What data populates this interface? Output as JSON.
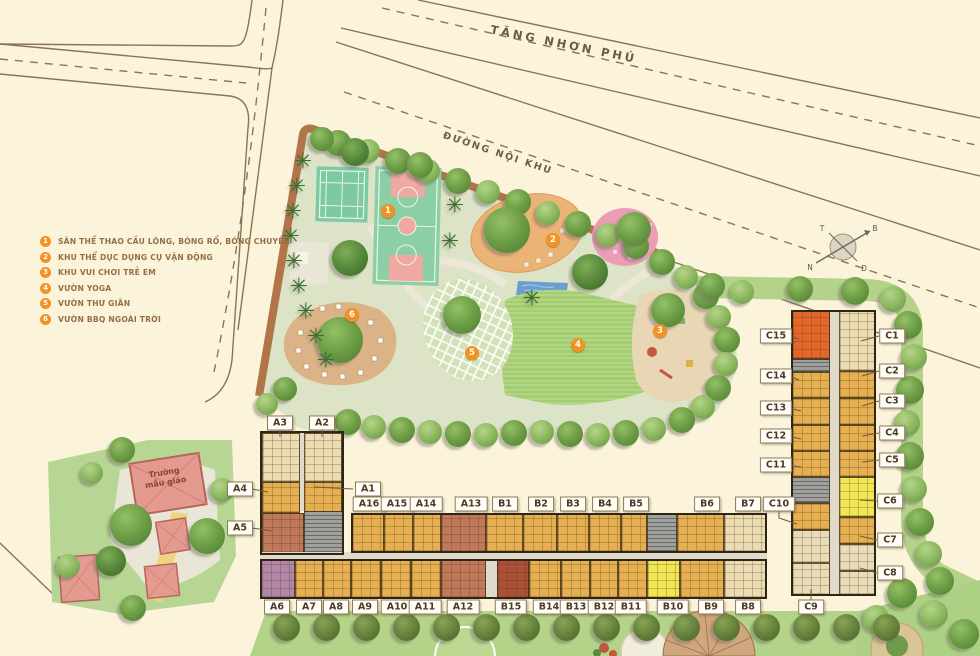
{
  "roads": {
    "main_label": "TĂNG NHƠN PHÚ",
    "internal_label": "ĐƯỜNG NỘI KHU"
  },
  "legend": {
    "items": [
      {
        "num": "1",
        "label": "SÂN THỂ THAO CẦU LÔNG, BÓNG RỔ, BÓNG CHUYỀN"
      },
      {
        "num": "2",
        "label": "KHU THỂ DỤC DỤNG CỤ VẬN ĐỘNG"
      },
      {
        "num": "3",
        "label": "KHU VUI CHƠI TRẺ EM"
      },
      {
        "num": "4",
        "label": "VƯỜN YOGA"
      },
      {
        "num": "5",
        "label": "VƯỜN THƯ GIÃN"
      },
      {
        "num": "6",
        "label": "VƯỜN BBQ NGOÀI TRỜI"
      }
    ]
  },
  "kindergarten": {
    "label": "Trường mẫu giáo"
  },
  "compass": {
    "north": "B",
    "south": "N",
    "east": "Đ",
    "west": "T"
  },
  "markers": [
    {
      "num": "1",
      "x": 388,
      "y": 211
    },
    {
      "num": "2",
      "x": 553,
      "y": 240
    },
    {
      "num": "3",
      "x": 660,
      "y": 331
    },
    {
      "num": "4",
      "x": 578,
      "y": 345
    },
    {
      "num": "5",
      "x": 472,
      "y": 353
    },
    {
      "num": "6",
      "x": 352,
      "y": 315
    }
  ],
  "building_labels": [
    {
      "id": "A3",
      "x": 280,
      "y": 423
    },
    {
      "id": "A2",
      "x": 322,
      "y": 423
    },
    {
      "id": "A4",
      "x": 240,
      "y": 489
    },
    {
      "id": "A5",
      "x": 240,
      "y": 528
    },
    {
      "id": "A1",
      "x": 368,
      "y": 489
    },
    {
      "id": "A16",
      "x": 369,
      "y": 504
    },
    {
      "id": "A15",
      "x": 397,
      "y": 504
    },
    {
      "id": "A14",
      "x": 426,
      "y": 504
    },
    {
      "id": "A13",
      "x": 471,
      "y": 504
    },
    {
      "id": "B1",
      "x": 505,
      "y": 504
    },
    {
      "id": "B2",
      "x": 541,
      "y": 504
    },
    {
      "id": "B3",
      "x": 573,
      "y": 504
    },
    {
      "id": "B4",
      "x": 605,
      "y": 504
    },
    {
      "id": "B5",
      "x": 636,
      "y": 504
    },
    {
      "id": "B6",
      "x": 707,
      "y": 504
    },
    {
      "id": "B7",
      "x": 748,
      "y": 504
    },
    {
      "id": "C10",
      "x": 779,
      "y": 504
    },
    {
      "id": "A6",
      "x": 277,
      "y": 607
    },
    {
      "id": "A7",
      "x": 309,
      "y": 607
    },
    {
      "id": "A8",
      "x": 336,
      "y": 607
    },
    {
      "id": "A9",
      "x": 365,
      "y": 607
    },
    {
      "id": "A10",
      "x": 397,
      "y": 607
    },
    {
      "id": "A11",
      "x": 425,
      "y": 607
    },
    {
      "id": "A12",
      "x": 463,
      "y": 607
    },
    {
      "id": "B15",
      "x": 511,
      "y": 607
    },
    {
      "id": "B14",
      "x": 549,
      "y": 607
    },
    {
      "id": "B13",
      "x": 576,
      "y": 607
    },
    {
      "id": "B12",
      "x": 604,
      "y": 607
    },
    {
      "id": "B11",
      "x": 631,
      "y": 607
    },
    {
      "id": "B10",
      "x": 673,
      "y": 607
    },
    {
      "id": "B9",
      "x": 711,
      "y": 607
    },
    {
      "id": "B8",
      "x": 748,
      "y": 607
    },
    {
      "id": "C9",
      "x": 811,
      "y": 607
    },
    {
      "id": "C15",
      "x": 776,
      "y": 336
    },
    {
      "id": "C14",
      "x": 776,
      "y": 376
    },
    {
      "id": "C13",
      "x": 776,
      "y": 408
    },
    {
      "id": "C12",
      "x": 776,
      "y": 436
    },
    {
      "id": "C11",
      "x": 776,
      "y": 465
    },
    {
      "id": "C1",
      "x": 892,
      "y": 336
    },
    {
      "id": "C2",
      "x": 892,
      "y": 371
    },
    {
      "id": "C3",
      "x": 892,
      "y": 401
    },
    {
      "id": "C4",
      "x": 892,
      "y": 433
    },
    {
      "id": "C5",
      "x": 892,
      "y": 460
    },
    {
      "id": "C6",
      "x": 890,
      "y": 501
    },
    {
      "id": "C7",
      "x": 890,
      "y": 540
    },
    {
      "id": "C8",
      "x": 890,
      "y": 573
    }
  ],
  "leaders": [
    "280,430 280,437",
    "322,430 322,437",
    "353,489 314,487",
    "252,489 268,492",
    "252,528 272,531",
    "789,336 799,339",
    "789,376 799,380",
    "789,408 801,411",
    "789,436 801,439",
    "789,465 801,467",
    "779,511 779,518 797,524",
    "879,336 861,341",
    "879,371 862,376",
    "879,401 862,406",
    "879,433 862,436",
    "879,460 862,462",
    "877,501 860,500",
    "877,540 860,536",
    "877,573 860,568",
    "811,600 811,589"
  ],
  "units": [
    {
      "id": "A3",
      "x": 262,
      "y": 433,
      "w": 38,
      "h": 49,
      "c": "beige"
    },
    {
      "id": "",
      "x": 300,
      "y": 433,
      "w": 4,
      "h": 78,
      "c": "corr"
    },
    {
      "id": "A2",
      "x": 304,
      "y": 433,
      "w": 38,
      "h": 49,
      "c": "beige"
    },
    {
      "id": "A4",
      "x": 262,
      "y": 482,
      "w": 38,
      "h": 31,
      "c": "amber"
    },
    {
      "id": "A1",
      "x": 304,
      "y": 482,
      "w": 38,
      "h": 31,
      "c": "amber"
    },
    {
      "id": "A5",
      "x": 262,
      "y": 513,
      "w": 42,
      "h": 40,
      "c": "red"
    },
    {
      "id": "",
      "x": 304,
      "y": 511,
      "w": 40,
      "h": 42,
      "c": "gray"
    },
    {
      "id": "A16",
      "x": 352,
      "y": 514,
      "w": 32,
      "h": 38,
      "c": "amber"
    },
    {
      "id": "A15",
      "x": 384,
      "y": 514,
      "w": 29,
      "h": 38,
      "c": "amber"
    },
    {
      "id": "A14",
      "x": 413,
      "y": 514,
      "w": 28,
      "h": 38,
      "c": "amber"
    },
    {
      "id": "A13",
      "x": 441,
      "y": 514,
      "w": 45,
      "h": 38,
      "c": "red"
    },
    {
      "id": "B1",
      "x": 486,
      "y": 514,
      "w": 37,
      "h": 38,
      "c": "amber"
    },
    {
      "id": "B2",
      "x": 523,
      "y": 514,
      "w": 34,
      "h": 38,
      "c": "amber"
    },
    {
      "id": "B3",
      "x": 557,
      "y": 514,
      "w": 32,
      "h": 38,
      "c": "amber"
    },
    {
      "id": "B4",
      "x": 589,
      "y": 514,
      "w": 32,
      "h": 38,
      "c": "amber"
    },
    {
      "id": "B5",
      "x": 621,
      "y": 514,
      "w": 26,
      "h": 38,
      "c": "amber"
    },
    {
      "id": "",
      "x": 647,
      "y": 514,
      "w": 30,
      "h": 38,
      "c": "gray"
    },
    {
      "id": "B6",
      "x": 677,
      "y": 514,
      "w": 47,
      "h": 38,
      "c": "amber"
    },
    {
      "id": "B7",
      "x": 724,
      "y": 514,
      "w": 42,
      "h": 38,
      "c": "beige"
    },
    {
      "id": "",
      "x": 260,
      "y": 552,
      "w": 507,
      "h": 8,
      "c": "corr"
    },
    {
      "id": "A6",
      "x": 261,
      "y": 560,
      "w": 34,
      "h": 38,
      "c": "purple"
    },
    {
      "id": "A7",
      "x": 295,
      "y": 560,
      "w": 28,
      "h": 38,
      "c": "amber"
    },
    {
      "id": "A8",
      "x": 323,
      "y": 560,
      "w": 28,
      "h": 38,
      "c": "amber"
    },
    {
      "id": "A9",
      "x": 351,
      "y": 560,
      "w": 30,
      "h": 38,
      "c": "amber"
    },
    {
      "id": "A10",
      "x": 381,
      "y": 560,
      "w": 30,
      "h": 38,
      "c": "amber"
    },
    {
      "id": "A11",
      "x": 411,
      "y": 560,
      "w": 30,
      "h": 38,
      "c": "amber"
    },
    {
      "id": "A12",
      "x": 441,
      "y": 560,
      "w": 45,
      "h": 38,
      "c": "red"
    },
    {
      "id": "",
      "x": 486,
      "y": 560,
      "w": 11,
      "h": 38,
      "c": "corr"
    },
    {
      "id": "B15",
      "x": 497,
      "y": 560,
      "w": 32,
      "h": 38,
      "c": "darkred"
    },
    {
      "id": "B14",
      "x": 529,
      "y": 560,
      "w": 32,
      "h": 38,
      "c": "amber"
    },
    {
      "id": "B13",
      "x": 561,
      "y": 560,
      "w": 29,
      "h": 38,
      "c": "amber"
    },
    {
      "id": "B12",
      "x": 590,
      "y": 560,
      "w": 28,
      "h": 38,
      "c": "amber"
    },
    {
      "id": "B11",
      "x": 618,
      "y": 560,
      "w": 29,
      "h": 38,
      "c": "amber"
    },
    {
      "id": "B10",
      "x": 647,
      "y": 560,
      "w": 33,
      "h": 38,
      "c": "yellow"
    },
    {
      "id": "B9",
      "x": 680,
      "y": 560,
      "w": 44,
      "h": 38,
      "c": "amber"
    },
    {
      "id": "B8",
      "x": 724,
      "y": 560,
      "w": 43,
      "h": 38,
      "c": "beige"
    },
    {
      "id": "C15",
      "x": 792,
      "y": 311,
      "w": 38,
      "h": 48,
      "c": "orange"
    },
    {
      "id": "",
      "x": 792,
      "y": 359,
      "w": 38,
      "h": 13,
      "c": "gray"
    },
    {
      "id": "C14",
      "x": 792,
      "y": 372,
      "w": 38,
      "h": 26,
      "c": "amber"
    },
    {
      "id": "C13",
      "x": 792,
      "y": 398,
      "w": 38,
      "h": 27,
      "c": "amber"
    },
    {
      "id": "C12",
      "x": 792,
      "y": 425,
      "w": 38,
      "h": 26,
      "c": "amber"
    },
    {
      "id": "C11",
      "x": 792,
      "y": 451,
      "w": 38,
      "h": 26,
      "c": "amber"
    },
    {
      "id": "",
      "x": 792,
      "y": 477,
      "w": 38,
      "h": 26,
      "c": "gray"
    },
    {
      "id": "C10",
      "x": 792,
      "y": 503,
      "w": 38,
      "h": 27,
      "c": "amber"
    },
    {
      "id": "",
      "x": 792,
      "y": 530,
      "w": 38,
      "h": 33,
      "c": "pale"
    },
    {
      "id": "",
      "x": 792,
      "y": 563,
      "w": 38,
      "h": 32,
      "c": "pale"
    },
    {
      "id": "",
      "x": 830,
      "y": 311,
      "w": 9,
      "h": 284,
      "c": "corr"
    },
    {
      "id": "C1",
      "x": 839,
      "y": 311,
      "w": 36,
      "h": 60,
      "c": "beige"
    },
    {
      "id": "C2",
      "x": 839,
      "y": 371,
      "w": 36,
      "h": 27,
      "c": "amber"
    },
    {
      "id": "C3",
      "x": 839,
      "y": 398,
      "w": 36,
      "h": 27,
      "c": "amber"
    },
    {
      "id": "C4",
      "x": 839,
      "y": 425,
      "w": 36,
      "h": 26,
      "c": "amber"
    },
    {
      "id": "C5",
      "x": 839,
      "y": 451,
      "w": 36,
      "h": 26,
      "c": "amber"
    },
    {
      "id": "C6",
      "x": 839,
      "y": 477,
      "w": 36,
      "h": 40,
      "c": "yellow"
    },
    {
      "id": "C7",
      "x": 839,
      "y": 517,
      "w": 36,
      "h": 27,
      "c": "amber"
    },
    {
      "id": "C8",
      "x": 839,
      "y": 544,
      "w": 36,
      "h": 27,
      "c": "pale"
    },
    {
      "id": "",
      "x": 839,
      "y": 571,
      "w": 36,
      "h": 24,
      "c": "pale"
    }
  ],
  "outlines": [
    {
      "x": 260,
      "y": 431,
      "w": 84,
      "h": 124
    },
    {
      "x": 351,
      "y": 513,
      "w": 416,
      "h": 40
    },
    {
      "x": 260,
      "y": 559,
      "w": 507,
      "h": 40
    },
    {
      "x": 791,
      "y": 310,
      "w": 85,
      "h": 286
    }
  ],
  "trees": [
    [
      338,
      143,
      26,
      "m"
    ],
    [
      368,
      151,
      24,
      "l"
    ],
    [
      398,
      161,
      26,
      "m"
    ],
    [
      428,
      171,
      24,
      "l"
    ],
    [
      458,
      181,
      26,
      "m"
    ],
    [
      488,
      192,
      24,
      "l"
    ],
    [
      518,
      202,
      26,
      "m"
    ],
    [
      548,
      213,
      24,
      "l"
    ],
    [
      578,
      224,
      26,
      "m"
    ],
    [
      608,
      235,
      24,
      "l"
    ],
    [
      636,
      246,
      26,
      "m"
    ],
    [
      662,
      262,
      26,
      "m"
    ],
    [
      686,
      277,
      24,
      "l"
    ],
    [
      706,
      296,
      26,
      "m"
    ],
    [
      719,
      317,
      24,
      "l"
    ],
    [
      727,
      340,
      26,
      "m"
    ],
    [
      726,
      364,
      24,
      "l"
    ],
    [
      718,
      388,
      26,
      "m"
    ],
    [
      703,
      407,
      24,
      "l"
    ],
    [
      682,
      420,
      26,
      "m"
    ],
    [
      654,
      429,
      24,
      "l"
    ],
    [
      626,
      433,
      26,
      "m"
    ],
    [
      598,
      435,
      24,
      "l"
    ],
    [
      570,
      434,
      26,
      "m"
    ],
    [
      542,
      432,
      24,
      "l"
    ],
    [
      514,
      433,
      26,
      "m"
    ],
    [
      486,
      435,
      24,
      "l"
    ],
    [
      458,
      434,
      26,
      "m"
    ],
    [
      430,
      432,
      24,
      "l"
    ],
    [
      402,
      430,
      26,
      "m"
    ],
    [
      374,
      427,
      24,
      "l"
    ],
    [
      348,
      422,
      26,
      "m"
    ],
    [
      285,
      389,
      24,
      "m"
    ],
    [
      267,
      404,
      22,
      "l"
    ],
    [
      507,
      230,
      46,
      "m"
    ],
    [
      590,
      272,
      36,
      "d"
    ],
    [
      634,
      229,
      34,
      "m"
    ],
    [
      462,
      315,
      38,
      "m"
    ],
    [
      340,
      340,
      46,
      "m"
    ],
    [
      668,
      310,
      34,
      "m"
    ],
    [
      350,
      258,
      36,
      "d"
    ],
    [
      355,
      152,
      28,
      "d"
    ],
    [
      420,
      165,
      26,
      "m"
    ],
    [
      322,
      139,
      24,
      "m"
    ],
    [
      712,
      286,
      26,
      "m"
    ],
    [
      742,
      292,
      24,
      "l"
    ],
    [
      800,
      289,
      26,
      "m"
    ],
    [
      855,
      291,
      28,
      "m"
    ],
    [
      893,
      299,
      26,
      "l"
    ],
    [
      908,
      325,
      28,
      "m"
    ],
    [
      914,
      357,
      26,
      "l"
    ],
    [
      910,
      390,
      28,
      "m"
    ],
    [
      907,
      423,
      26,
      "l"
    ],
    [
      910,
      456,
      28,
      "m"
    ],
    [
      914,
      489,
      26,
      "l"
    ],
    [
      920,
      522,
      28,
      "m"
    ],
    [
      929,
      554,
      26,
      "l"
    ],
    [
      940,
      581,
      28,
      "m"
    ],
    [
      902,
      593,
      30,
      "m"
    ],
    [
      934,
      614,
      28,
      "l"
    ],
    [
      964,
      634,
      30,
      "m"
    ],
    [
      876,
      618,
      26,
      "l"
    ],
    [
      286,
      627,
      27,
      "o"
    ],
    [
      326,
      627,
      27,
      "o"
    ],
    [
      366,
      627,
      27,
      "o"
    ],
    [
      406,
      627,
      27,
      "o"
    ],
    [
      446,
      627,
      27,
      "o"
    ],
    [
      486,
      627,
      27,
      "o"
    ],
    [
      526,
      627,
      27,
      "o"
    ],
    [
      566,
      627,
      27,
      "o"
    ],
    [
      606,
      627,
      27,
      "o"
    ],
    [
      646,
      627,
      27,
      "o"
    ],
    [
      686,
      627,
      27,
      "o"
    ],
    [
      726,
      627,
      27,
      "o"
    ],
    [
      766,
      627,
      27,
      "o"
    ],
    [
      806,
      627,
      27,
      "o"
    ],
    [
      846,
      627,
      27,
      "o"
    ],
    [
      886,
      627,
      27,
      "o"
    ],
    [
      122,
      450,
      26,
      "m"
    ],
    [
      131,
      525,
      42,
      "m"
    ],
    [
      111,
      561,
      30,
      "d"
    ],
    [
      68,
      566,
      24,
      "l"
    ],
    [
      133,
      608,
      26,
      "m"
    ],
    [
      207,
      536,
      36,
      "m"
    ],
    [
      222,
      490,
      24,
      "l"
    ],
    [
      92,
      473,
      22,
      "l"
    ]
  ],
  "palms": [
    [
      303,
      163
    ],
    [
      297,
      188
    ],
    [
      293,
      213
    ],
    [
      291,
      238
    ],
    [
      294,
      263
    ],
    [
      299,
      288
    ],
    [
      306,
      313
    ],
    [
      316,
      338
    ],
    [
      326,
      362
    ],
    [
      455,
      207
    ],
    [
      450,
      243
    ],
    [
      532,
      300
    ]
  ]
}
